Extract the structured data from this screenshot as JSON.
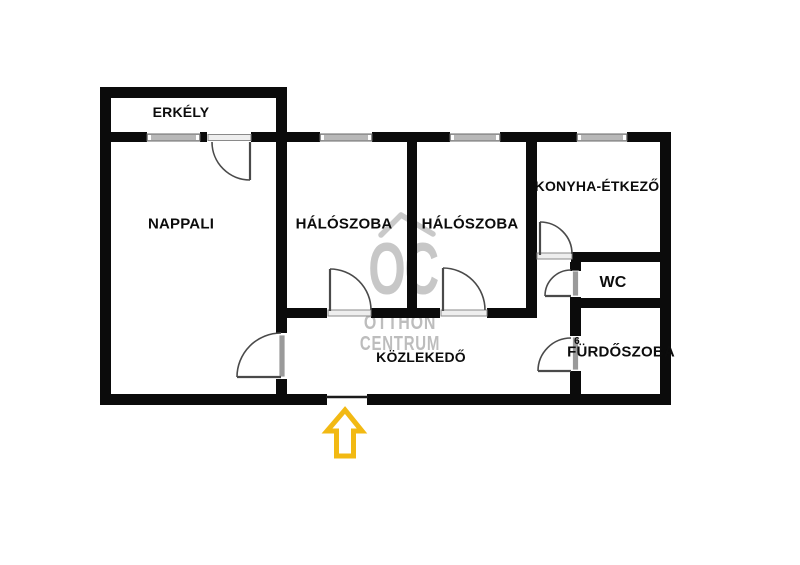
{
  "rooms": {
    "erkely": "ERKÉLY",
    "nappali": "NAPPALI",
    "haloszoba1": "HÁLÓSZOBA",
    "haloszoba2": "HÁLÓSZOBA",
    "konyha_etkezo": "KONYHA-ÉTKEZŐ",
    "wc": "WC",
    "furdoszoba": "FÜRDŐSZOBA",
    "kozlekedo": "KÖZLEKEDŐ"
  },
  "annotations": {
    "door_number": "6"
  },
  "watermark": {
    "logo": "OC",
    "line1": "OTTHON",
    "line2": "CENTRUM"
  },
  "colors": {
    "wall": "#0b0b0b",
    "window_fill": "#b8b8b8",
    "window_edge": "#6a6a6a",
    "door_line": "#4a4a4a",
    "door_leaf": "#9a9a9a",
    "sill_fill": "#eeeeee",
    "watermark_gray": "#c7c7c7",
    "arrow_yellow": "#f2b913",
    "label_black": "#0c0c0c",
    "background": "#ffffff"
  }
}
